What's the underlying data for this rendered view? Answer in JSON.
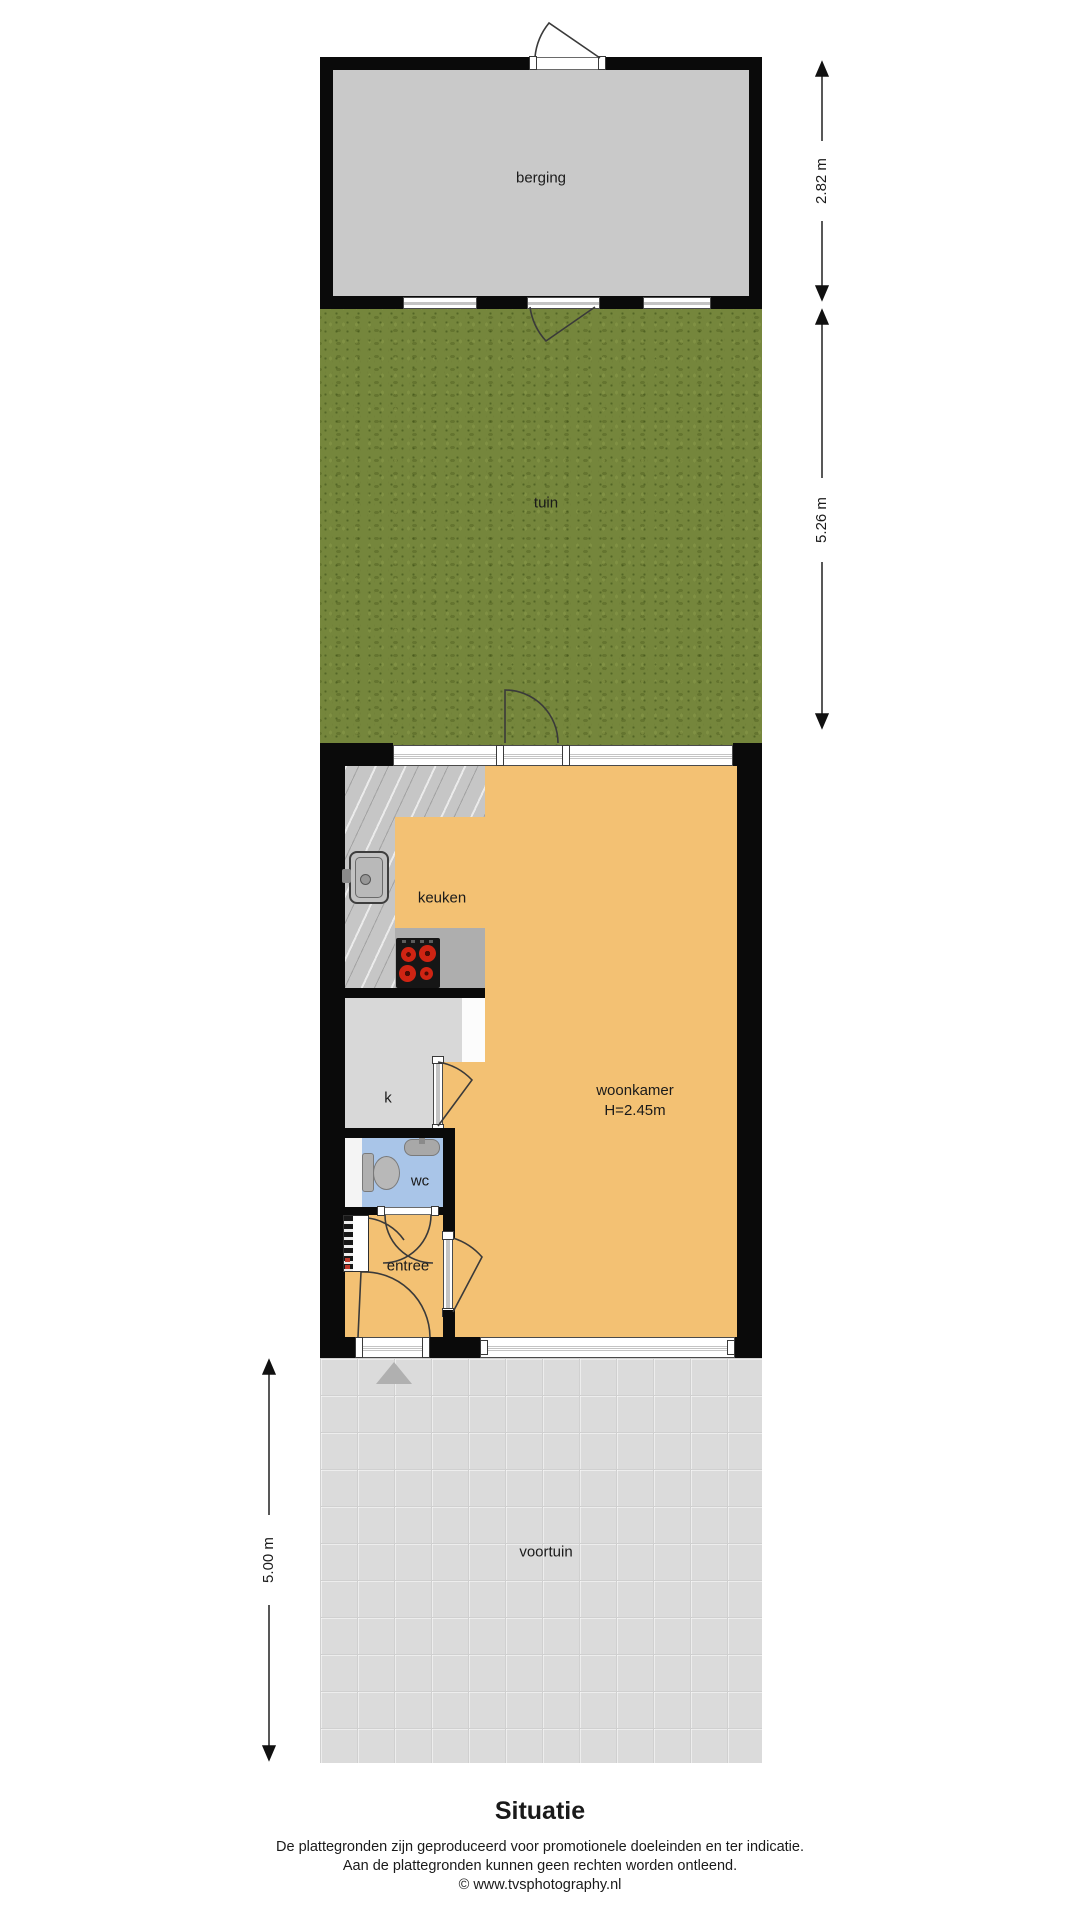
{
  "title": "Situatie",
  "rooms": {
    "berging": "berging",
    "tuin": "tuin",
    "keuken": "keuken",
    "woonkamer": "woonkamer",
    "woonkamer_height": "H=2.45m",
    "closet": "k",
    "wc": "wc",
    "entree": "entree",
    "voortuin": "voortuin"
  },
  "dimensions": {
    "berging_depth": "2.82 m",
    "tuin_depth": "5.26 m",
    "voortuin_depth": "5.00 m"
  },
  "footer": {
    "line1": "De plattegronden zijn geproduceerd voor promotionele doeleinden en ter indicatie.",
    "line2": "Aan de plattegronden kunnen geen rechten worden ontleend.",
    "line3": "© www.tvsphotography.nl"
  },
  "icons": {
    "sink": "sink-icon",
    "stove": "stove-icon",
    "toilet": "toilet-icon",
    "washbasin": "washbasin-icon",
    "meter_cupboard": "meter-cupboard-icon",
    "entrance_marker": "entrance-triangle-icon",
    "doors": "door-swing-arc"
  },
  "colors": {
    "wall": "#0a0a0a",
    "berging_floor": "#c9c9c9",
    "grass": "#75863c",
    "living_floor": "#f3c173",
    "wc_floor": "#a9c5e8",
    "closet_floor": "#d8d8d8",
    "voortuin_tiles": "#dbdbdb",
    "burner_red": "#cf2413"
  }
}
